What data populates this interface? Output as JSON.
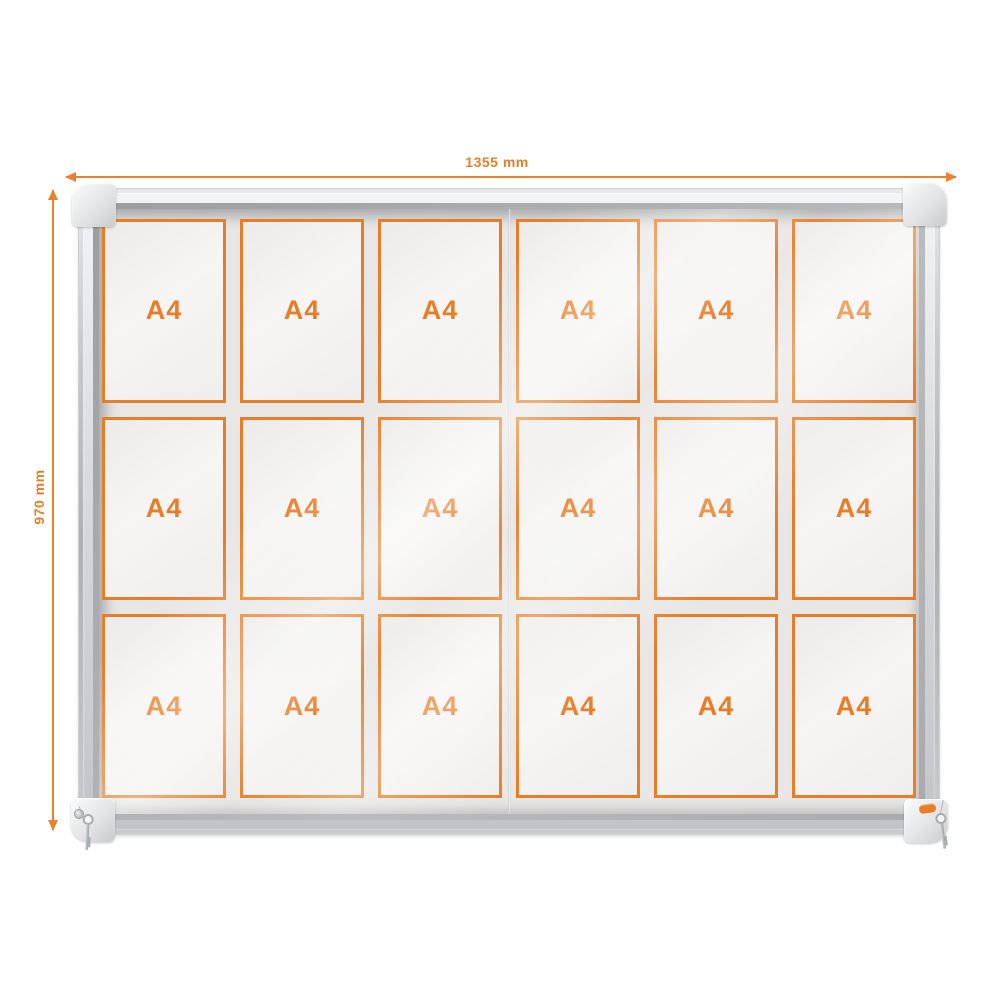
{
  "product": {
    "name": "glazed display case with sliding doors",
    "dimensions": {
      "width_label": "1355 mm",
      "height_label": "970 mm"
    }
  },
  "board": {
    "columns": 6,
    "rows": 3,
    "sheet_label": "A4",
    "sheets": [
      "A4",
      "A4",
      "A4",
      "A4",
      "A4",
      "A4",
      "A4",
      "A4",
      "A4",
      "A4",
      "A4",
      "A4",
      "A4",
      "A4",
      "A4",
      "A4",
      "A4",
      "A4"
    ]
  },
  "icons": {
    "key_left": "key-icon",
    "key_right": "key-icon",
    "lock": "lock-cylinder-icon",
    "badge": "nobo-logo-badge"
  },
  "colors": {
    "accent_orange": "#E87D27",
    "dimension_line_orange": "#E8822F",
    "frame_silver": "#C2C4C7",
    "board_background": "#E8E7E5",
    "sheet_background": "#F3F2F0",
    "page_background": "#FFFFFF"
  }
}
